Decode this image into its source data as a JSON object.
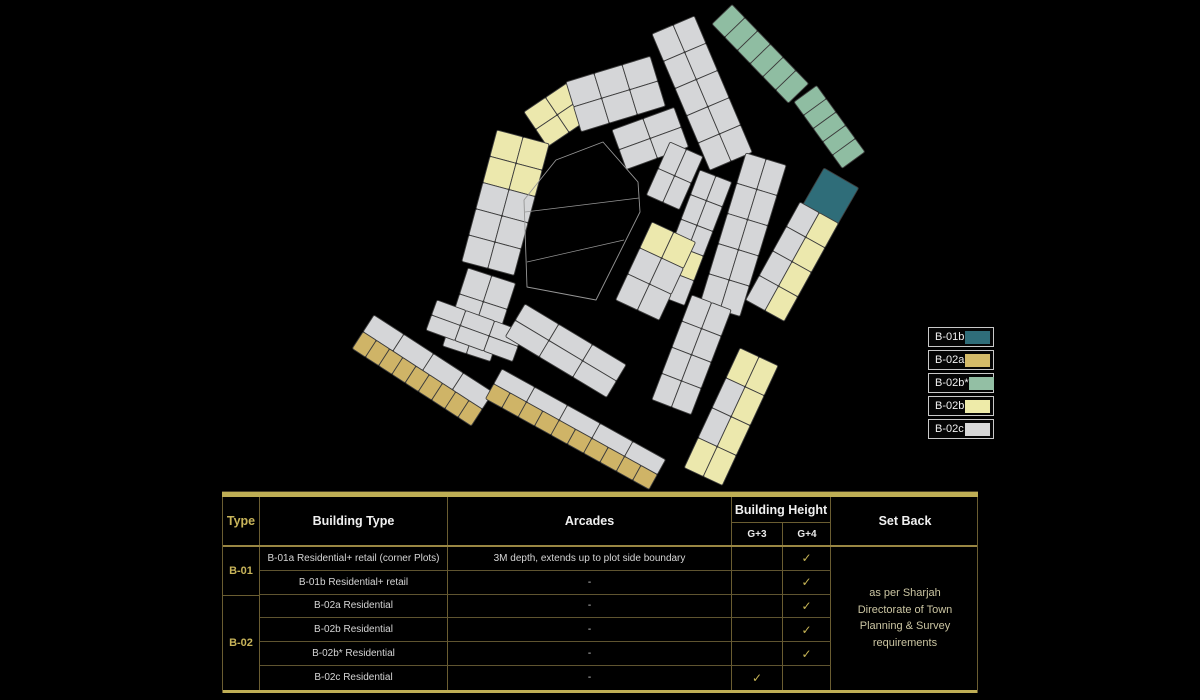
{
  "page": {
    "background": "#000000"
  },
  "map": {
    "palette": {
      "g": "#d5d6d8",
      "y": "#ece8ad",
      "t": "#cfb467",
      "s": "#8fbda2",
      "T": "#2f6d79"
    },
    "cell_stroke": "#3d3d3d",
    "blocks": [
      {
        "x": 524,
        "y": 112,
        "a": -34,
        "w": 52,
        "h": 42,
        "rows": [
          [
            2,
            "y"
          ],
          [
            2,
            "y"
          ]
        ]
      },
      {
        "x": 566,
        "y": 82,
        "a": -17,
        "w": 88,
        "h": 52,
        "rows": [
          [
            3,
            "g"
          ],
          [
            3,
            "g"
          ]
        ]
      },
      {
        "x": 652,
        "y": 34,
        "a": -23,
        "w": 46,
        "h": 148,
        "rows": [
          [
            2,
            "g"
          ],
          [
            2,
            "g"
          ],
          [
            2,
            "g"
          ],
          [
            2,
            "g"
          ],
          [
            2,
            "g"
          ]
        ]
      },
      {
        "x": 712,
        "y": 24,
        "a": -44,
        "w": 28,
        "h": 110,
        "rows": [
          [
            1,
            "s"
          ],
          [
            1,
            "s"
          ],
          [
            1,
            "s"
          ],
          [
            1,
            "s"
          ],
          [
            1,
            "s"
          ],
          [
            1,
            "s"
          ]
        ]
      },
      {
        "x": 794,
        "y": 102,
        "a": -36,
        "w": 28,
        "h": 82,
        "rows": [
          [
            1,
            "s"
          ],
          [
            1,
            "s"
          ],
          [
            1,
            "s"
          ],
          [
            1,
            "s"
          ],
          [
            1,
            "s"
          ]
        ]
      },
      {
        "x": 824,
        "y": 168,
        "a": 30,
        "w": 40,
        "h": 44,
        "rows": [
          [
            1,
            "T"
          ]
        ]
      },
      {
        "x": 800,
        "y": 202,
        "a": 29,
        "w": 44,
        "h": 112,
        "rows": [
          [
            2,
            "g"
          ],
          [
            2,
            "g"
          ],
          [
            2,
            "g"
          ],
          [
            2,
            "g"
          ]
        ],
        "cells": {
          "1,2": "y",
          "2,2": "y",
          "3,2": "y",
          "4,2": "y"
        }
      },
      {
        "x": 746,
        "y": 153,
        "a": 17,
        "w": 42,
        "h": 158,
        "rows": [
          [
            2,
            "g"
          ],
          [
            2,
            "g"
          ],
          [
            2,
            "g"
          ],
          [
            2,
            "g"
          ],
          [
            2,
            "g"
          ]
        ]
      },
      {
        "x": 700,
        "y": 170,
        "a": 21,
        "w": 34,
        "h": 132,
        "rows": [
          [
            2,
            "g"
          ],
          [
            2,
            "g"
          ],
          [
            2,
            "g"
          ],
          [
            2,
            "g"
          ],
          [
            2,
            "g"
          ]
        ],
        "cells": {
          "4,1": "y",
          "4,2": "y"
        }
      },
      {
        "x": 612,
        "y": 130,
        "a": -20,
        "w": 66,
        "h": 42,
        "rows": [
          [
            2,
            "g"
          ],
          [
            2,
            "g"
          ]
        ]
      },
      {
        "x": 670,
        "y": 142,
        "a": 24,
        "w": 36,
        "h": 58,
        "rows": [
          [
            2,
            "g"
          ],
          [
            2,
            "g"
          ]
        ]
      },
      {
        "x": 652,
        "y": 222,
        "a": 25,
        "w": 48,
        "h": 86,
        "rows": [
          [
            2,
            "g"
          ],
          [
            2,
            "g"
          ],
          [
            2,
            "g"
          ]
        ],
        "cells": {
          "1,1": "y",
          "1,2": "y"
        }
      },
      {
        "x": 692,
        "y": 295,
        "a": 21,
        "w": 42,
        "h": 112,
        "rows": [
          [
            2,
            "g"
          ],
          [
            2,
            "g"
          ],
          [
            2,
            "g"
          ],
          [
            2,
            "g"
          ]
        ]
      },
      {
        "x": 740,
        "y": 348,
        "a": 25,
        "w": 42,
        "h": 132,
        "rows": [
          [
            2,
            "g"
          ],
          [
            2,
            "g"
          ],
          [
            2,
            "g"
          ],
          [
            2,
            "g"
          ]
        ],
        "cells": {
          "1,1": "y",
          "1,2": "y",
          "2,2": "y",
          "3,2": "y",
          "4,1": "y",
          "4,2": "y"
        }
      },
      {
        "x": 497,
        "y": 130,
        "a": 15,
        "w": 54,
        "h": 136,
        "rows": [
          [
            2,
            "g"
          ],
          [
            2,
            "g"
          ],
          [
            2,
            "g"
          ],
          [
            2,
            "g"
          ],
          [
            2,
            "g"
          ]
        ],
        "cells": {
          "1,1": "y",
          "1,2": "y",
          "2,1": "y",
          "2,2": "y"
        }
      },
      {
        "x": 468,
        "y": 268,
        "a": 18,
        "w": 50,
        "h": 82,
        "rows": [
          [
            2,
            "g"
          ],
          [
            2,
            "g"
          ],
          [
            2,
            "g"
          ]
        ]
      },
      {
        "x": 437,
        "y": 300,
        "a": 20,
        "w": 92,
        "h": 32,
        "rows": [
          [
            3,
            "g"
          ],
          [
            3,
            "g"
          ]
        ]
      },
      {
        "x": 525,
        "y": 304,
        "a": 31,
        "w": 118,
        "h": 38,
        "rows": [
          [
            3,
            "g"
          ],
          [
            3,
            "g"
          ]
        ]
      },
      {
        "x": 374,
        "y": 315,
        "a": 33,
        "w": 142,
        "h": 40,
        "rows": [
          [
            4,
            "g"
          ],
          [
            9,
            "t"
          ]
        ]
      },
      {
        "x": 502,
        "y": 369,
        "a": 29,
        "w": 187,
        "h": 34,
        "rows": [
          [
            5,
            "g"
          ],
          [
            10,
            "t"
          ]
        ]
      }
    ],
    "empty_parcel": {
      "points": "603,142 638,182 640,212 596,300 527,287 524,200 556,160",
      "inner_lines": [
        [
          525,
          212,
          639,
          198
        ],
        [
          527,
          262,
          624,
          240
        ]
      ],
      "stroke": "#969696"
    }
  },
  "legend": {
    "items": [
      {
        "label": "B-01b",
        "color": "#2f6d79"
      },
      {
        "label": "B-02a",
        "color": "#d4bb69"
      },
      {
        "label": "B-02b*",
        "color": "#93bfa4"
      },
      {
        "label": "B-02b",
        "color": "#eeeba9"
      },
      {
        "label": "B-02c",
        "color": "#d8d8d8"
      }
    ]
  },
  "table": {
    "headers": {
      "type": "Type",
      "building_type": "Building Type",
      "arcades": "Arcades",
      "building_height": "Building Height",
      "g3": "G+3",
      "g4": "G+4",
      "set_back": "Set Back"
    },
    "groups": [
      {
        "label": "B-01",
        "span": 2
      },
      {
        "label": "B-02",
        "span": 4
      }
    ],
    "rows": [
      {
        "building_type": "B-01a Residential+ retail (corner Plots)",
        "arcades": "3M depth, extends up to plot side boundary",
        "g3": false,
        "g4": true
      },
      {
        "building_type": "B-01b Residential+ retail",
        "arcades": "-",
        "g3": false,
        "g4": true
      },
      {
        "building_type": "B-02a Residential",
        "arcades": "-",
        "g3": false,
        "g4": true
      },
      {
        "building_type": "B-02b Residential",
        "arcades": "-",
        "g3": false,
        "g4": true
      },
      {
        "building_type": "B-02b* Residential",
        "arcades": "-",
        "g3": false,
        "g4": true
      },
      {
        "building_type": "B-02c Residential",
        "arcades": "-",
        "g3": true,
        "g4": false
      }
    ],
    "check_glyph": "✓",
    "setback_note": "as per Sharjah Directorate of Town Planning & Survey requirements",
    "accent_color": "#bfae55"
  }
}
